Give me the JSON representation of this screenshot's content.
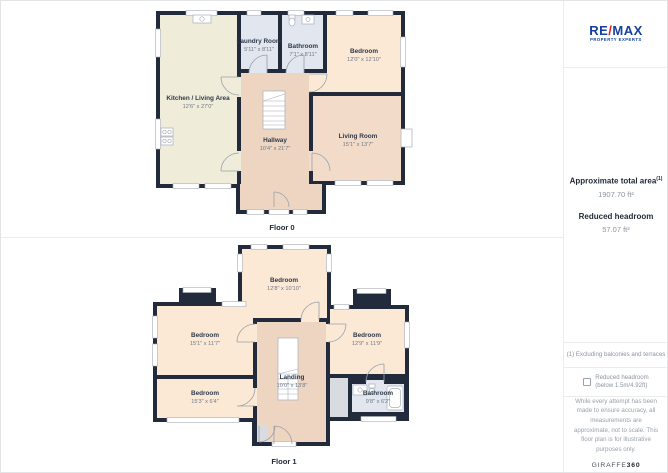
{
  "panels": {
    "floor0": {
      "caption": "Floor 0",
      "rooms": [
        {
          "name": "Laundry Room",
          "dims": "5'11\" x 8'11\""
        },
        {
          "name": "Bathroom",
          "dims": "7'1\" x 8'11\""
        },
        {
          "name": "Bedroom",
          "dims": "12'0\" x 12'10\""
        },
        {
          "name": "Kitchen / Living Area",
          "dims": "12'6\" x 27'0\""
        },
        {
          "name": "Hallway",
          "dims": "10'4\" x 21'7\""
        },
        {
          "name": "Living Room",
          "dims": "15'1\" x 13'7\""
        }
      ]
    },
    "floor1": {
      "caption": "Floor 1",
      "rooms": [
        {
          "name": "Bedroom",
          "dims": "12'8\" x 10'10\""
        },
        {
          "name": "Bedroom",
          "dims": "15'1\" x 11'7\""
        },
        {
          "name": "Bedroom",
          "dims": "12'9\" x 11'9\""
        },
        {
          "name": "Bedroom",
          "dims": "15'3\" x 6'4\""
        },
        {
          "name": "Landing",
          "dims": "10'0\" x 13'8\""
        },
        {
          "name": "Bathroom",
          "dims": "9'8\" x 6'2\""
        }
      ]
    }
  },
  "sidebar": {
    "logo": {
      "brand_re": "RE",
      "brand_slash": "/",
      "brand_max": "MAX",
      "tagline": "PROPERTY EXPERTS"
    },
    "total_area_label": "Approximate total area",
    "total_area_superscript": "(1)",
    "total_area_value": "1907.70 ft²",
    "reduced_headroom_label": "Reduced headroom",
    "reduced_headroom_value": "57.07 ft²",
    "footnote": "(1) Excluding balconies and terraces",
    "checkbox_line1": "Reduced headroom",
    "checkbox_line2": "(below 1.5m/4.92ft)",
    "disclaimer": "While every attempt has been made to ensure accuracy, all measurements are approximate, not to scale. This floor plan is for illustrative purposes only.",
    "brand_footer_regular": "GIRAFFE",
    "brand_footer_bold": "360"
  },
  "colors": {
    "wall": "#212b3b",
    "kitchen_fill": "#f0ecda",
    "bedroom_fill": "#fbe9d6",
    "hall_fill": "#eed5c1",
    "wet_room_fill": "#e2e6ef",
    "reduced_headroom_fill": "#d8dbdf",
    "remax_blue": "#1440a0",
    "remax_red": "#dd1d2d"
  },
  "icons": {
    "checkbox": "empty-square",
    "stairs": "stepped-lines",
    "door": "quarter-arc",
    "window": "white-wall-gap",
    "stove": "four-burners",
    "sink": "basin-circle",
    "bathtub": "rounded-rect",
    "toilet": "bowl"
  }
}
